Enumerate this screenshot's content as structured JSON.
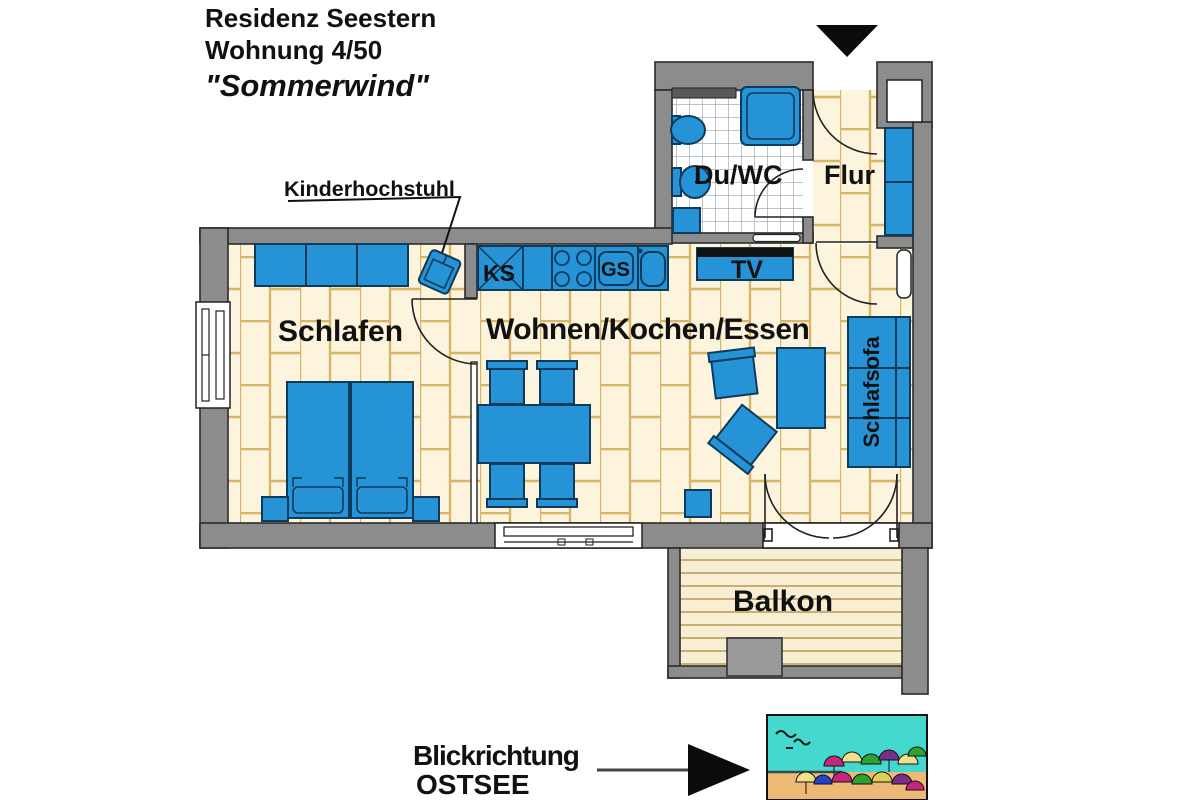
{
  "title": {
    "line1": "Residenz Seestern",
    "line2": "Wohnung 4/50",
    "line3": "\"Sommerwind\""
  },
  "rooms": {
    "schlafen": "Schlafen",
    "wohnen_kochen_essen": "Wohnen/Kochen/Essen",
    "du_wc": "Du/WC",
    "flur": "Flur",
    "balkon": "Balkon"
  },
  "furniture": {
    "schlafsofa": "Schlafsofa",
    "ks": "KS",
    "gs": "GS",
    "tv": "TV"
  },
  "annotations": {
    "kinderhochstuhl": "Kinderhochstuhl"
  },
  "view_direction": {
    "line1": "Blickrichtung",
    "line2": "OSTSEE"
  },
  "colors": {
    "furniture_blue": "#2593D5",
    "wall_gray": "#8C8C8C",
    "floor_tile_cream": "#FCF4DC",
    "tile_grout": "#D8B568",
    "bath_tile_white": "#FFFFFF",
    "balcony_plank": "#F7EED4",
    "beach_sky": "#45D8CE",
    "beach_sand": "#EEB877"
  }
}
